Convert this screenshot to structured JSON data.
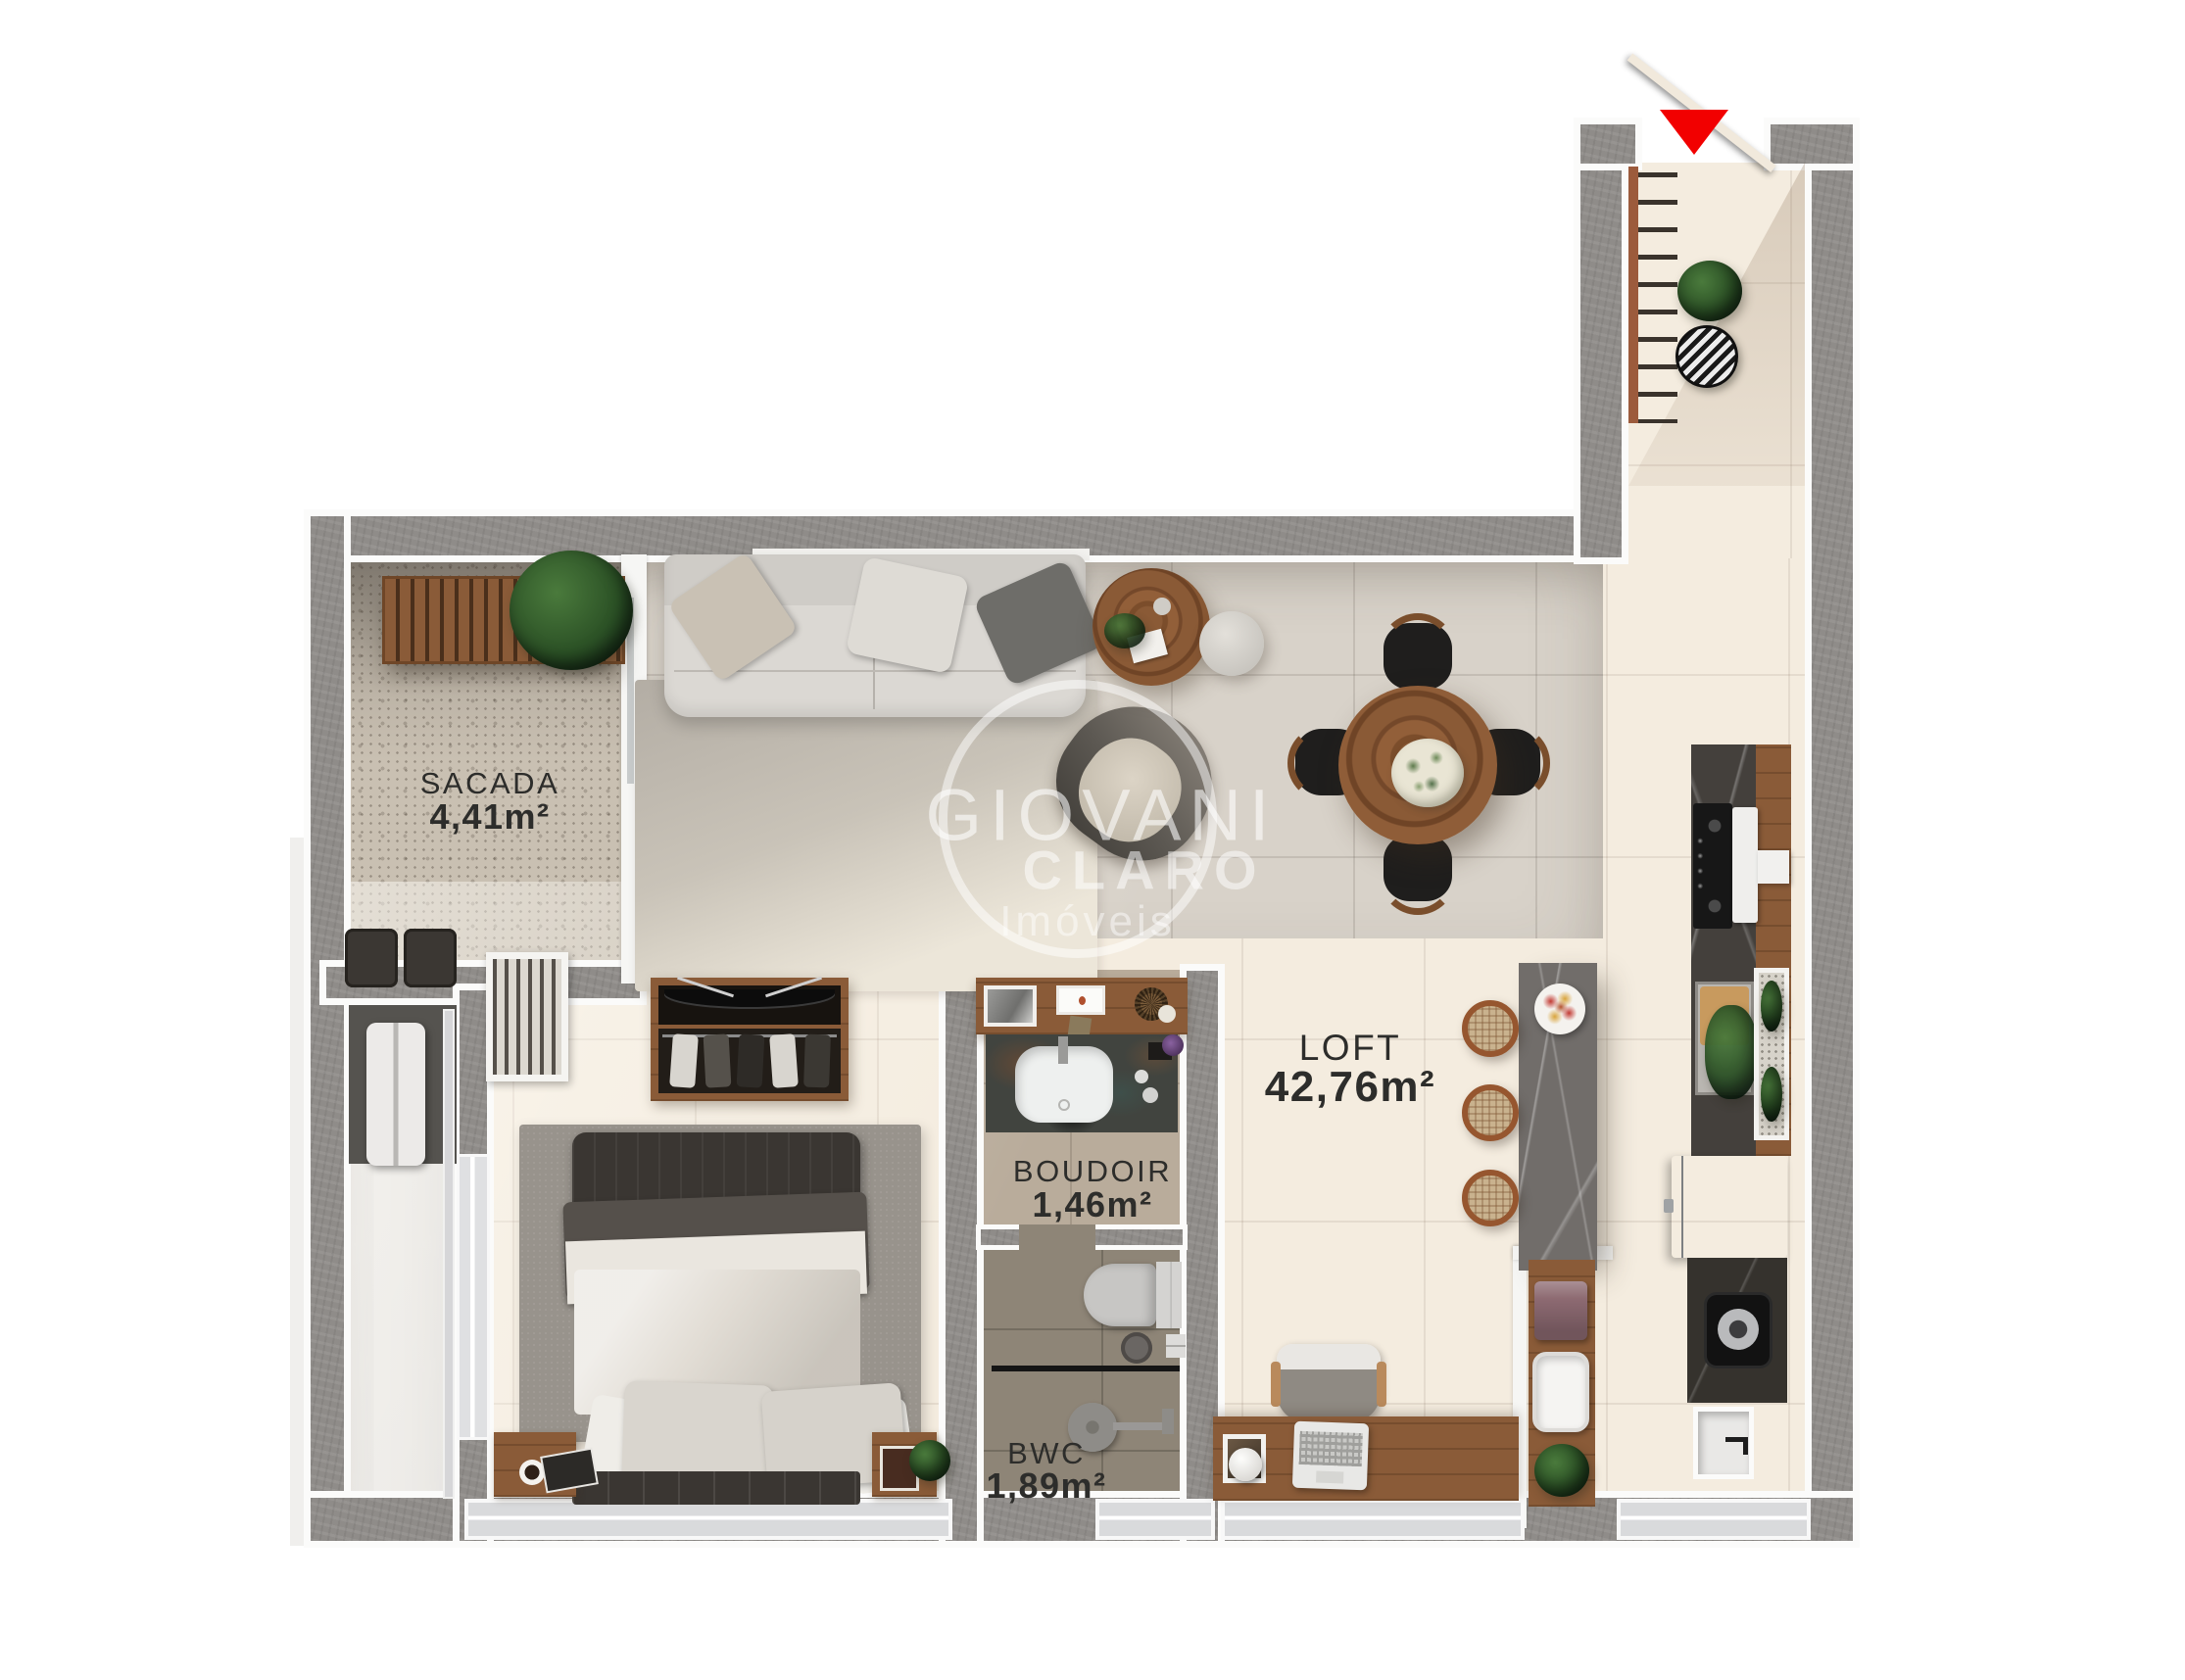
{
  "plan": {
    "rooms": [
      {
        "name": "SACADA",
        "area": "4,41m²"
      },
      {
        "name": "LOFT",
        "area": "42,76m²"
      },
      {
        "name": "BOUDOIR",
        "area": "1,46m²"
      },
      {
        "name": "BWC",
        "area": "1,89m²"
      }
    ],
    "watermark": {
      "line1": "GIOVANI",
      "line2": "CLARO",
      "line3": "Imóveis"
    },
    "entrance": {
      "marker": "triangle-down-icon",
      "color": "#f20000"
    },
    "palette": {
      "wall_gray": "#8f8c89",
      "floor_cream": "#f4ecdf",
      "floor_gray_tile": "#d8d2c9",
      "boudoir_floor": "#b9ac9b",
      "bwc_floor": "#8e8577",
      "wood_accent": "#8a5b38",
      "label_text": "#2d2d2b"
    }
  }
}
